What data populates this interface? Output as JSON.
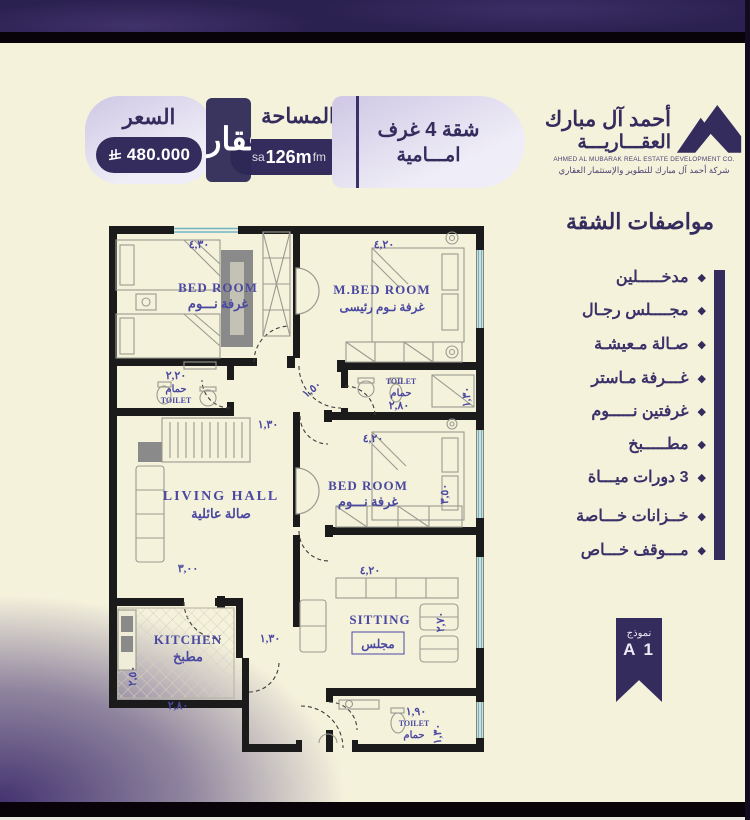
{
  "header": {
    "price": {
      "label": "السعر",
      "value": "480.000"
    },
    "area": {
      "label": "المساحة",
      "value": "126m",
      "wm_prefix": "sa",
      "wm_suffix": "fm"
    },
    "watermark": "عقار",
    "unit": {
      "line1": "شقة 4 غرف",
      "line2": "امـــامية"
    },
    "logo": {
      "name_line1": "أحمد آل مبارك",
      "name_line2": "العقـــاريـــة",
      "english": "AHMED AL MUBARAK REAL ESTATE DEVELOPMENT CO.",
      "tagline": "شركة أحمد آل مبارك للتطوير والإستثمار العقاري"
    }
  },
  "specs": {
    "title": "مواصفات الشقة",
    "bullet": "◆",
    "items": [
      "مدخـــــلين",
      "مجــــلس رجـال",
      "صـالة مـعيشـة",
      "غـــرفة مـاستر",
      "غرفتين نـــــوم",
      "مطـــــبخ",
      "3 دورات ميـــاة",
      "خــزانات خـــاصة",
      "مـــوقف خـــاص"
    ]
  },
  "badge": {
    "label": "نموذج",
    "value": "A 1"
  },
  "plan": {
    "bedroom1": {
      "en": "BED ROOM",
      "ar": "غرفة نـــوم",
      "dim_top": "٤,٣٠"
    },
    "master": {
      "en": "M.BED ROOM",
      "ar": "غرفة نـوم رئيسى",
      "dim_top": "٤,٢٠"
    },
    "toilet1": {
      "en": "TOILET",
      "ar": "حمام",
      "dim": "٢,٢٠"
    },
    "toilet2": {
      "en": "TOILET",
      "ar": "حمام",
      "dim": "٢,٨٠",
      "dim_side": "١,٣٠"
    },
    "hall": {
      "en": "LIVING HALL",
      "ar": "صالة عائلية",
      "dim_bottom": "٣,٠٠"
    },
    "corridor": {
      "dim1": "١,٥٠",
      "dim2": "١,٣٠",
      "dim3": "١,٣٠"
    },
    "bedroom2": {
      "en": "BED ROOM",
      "ar": "غرفة نـــوم",
      "dim_top": "٤,٢٠",
      "dim_side": "٣,٥٠"
    },
    "kitchen": {
      "en": "KITCHEN",
      "ar": "مطبخ",
      "dim_side": "٢,٥٠",
      "dim_bottom": "٢,٨٠"
    },
    "sitting": {
      "en": "SITTING",
      "ar": "مجلس",
      "dim_top": "٤,٢٠",
      "dim_side": "٢,٧٠"
    },
    "toilet3": {
      "en": "TOILET",
      "ar": "حمام",
      "dim": "١,٩٠",
      "dim_side": "١,٣٠"
    }
  }
}
